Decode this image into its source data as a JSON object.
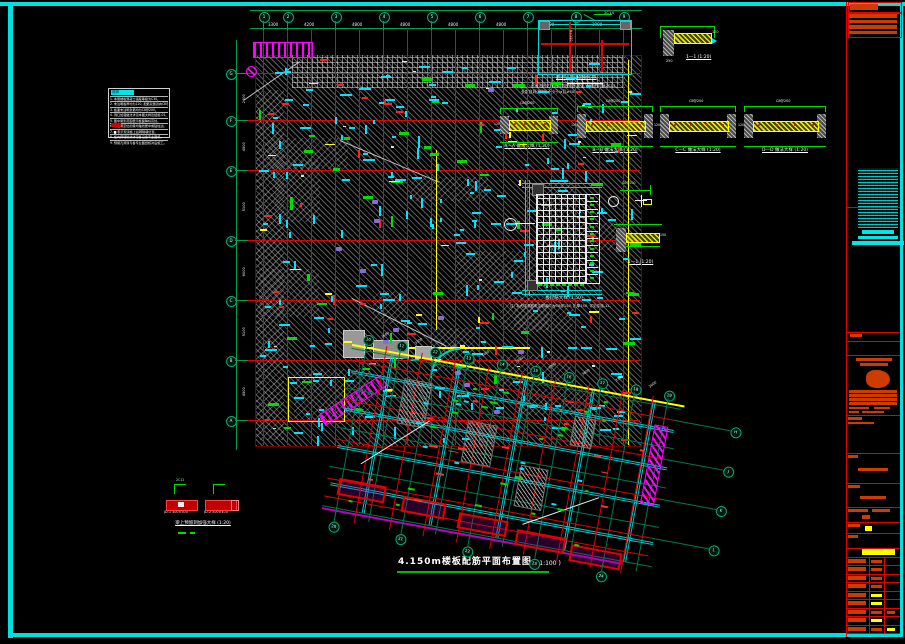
{
  "colors": {
    "frame_cyan": "#00e0e0",
    "grid_red": "#e60000",
    "dim_green": "#00a050",
    "anno_cyan": "#00e5ff",
    "rebar_green": "#00dd00",
    "yellow": "#ffff00",
    "magenta": "#ff00ff",
    "title_orange": "#cc3c00",
    "white": "#ffffff"
  },
  "notes_box": {
    "title": "说明",
    "rows": [
      "1. 本层楼板混凝土强度等级为C30。",
      "2. 未注明板厚均为120, 配筋双层双向C8@200。",
      "3. 板面未注明负筋均为C8@200。",
      "4. 洞口加强做法详见本图大样及结施-01。",
      "5. 图中阴影范围表示板面降标高处。",
      "6. 未注明定位的梁均轴线居中或贴柱边。",
      "7. ▆ 表示现浇板上后砌隔墙位置。",
      "8. 板内预埋管线详见各设备专业图纸。",
      "9. 预留孔洞须与各专业图纸核对后施工。"
    ]
  },
  "main_plan": {
    "title": "4.150m楼板配筋平面布置图",
    "scale": "( 1:100 )",
    "top_total": "34800",
    "top_bubbles": [
      "1",
      "2",
      "3",
      "4",
      "5",
      "6",
      "7",
      "8",
      "9"
    ],
    "top_dims": [
      "3300",
      "4200",
      "4800",
      "4800",
      "4800",
      "4800",
      "4200",
      "3900"
    ],
    "left_bubbles": [
      "G",
      "F",
      "E",
      "D",
      "C",
      "B",
      "A"
    ],
    "left_dims": [
      "2400",
      "4500",
      "5100",
      "6000",
      "5100",
      "4500"
    ]
  },
  "wing": {
    "top_bubbles": [
      "10",
      "11",
      "12",
      "13",
      "14",
      "15",
      "16",
      "17",
      "18",
      "19"
    ],
    "top_dims": [
      "3600",
      "3300",
      "3300",
      "3600",
      "3300",
      "3300",
      "3600",
      "3300",
      "3600"
    ],
    "bottom_bubbles": [
      "20",
      "21",
      "22",
      "23",
      "24"
    ],
    "right_bubbles": [
      "H",
      "J",
      "K",
      "L"
    ]
  },
  "details": {
    "opening": {
      "caption": "板洞口加强配筋示意",
      "note1": "注:1. 凡未注明之板洞口均按本图加强, 洞边附加筋2C14,",
      "note2": "      长度自洞边伸出不小于la且≥500。",
      "rebar_label": "2C14"
    },
    "s11a": {
      "caption": "1—1 (1:20)"
    },
    "sections": [
      {
        "caption": "A—A 做法大样 (1:20)"
      },
      {
        "caption": "B—B 做法大样 (1:20)"
      },
      {
        "caption": "C—C 做法大样 (1:20)"
      },
      {
        "caption": "D—D 做法大样 (1:20)"
      }
    ],
    "grid_plan": {
      "caption": "板配筋大样 (1:50)",
      "note": "注: 本大样钢筋未注明者均为C8@150, 板厚150, 详见结施-15。"
    },
    "s11b": {
      "caption": "1—1 (1:20)"
    },
    "hole": {
      "caption": "梁上预留洞加强大样 (1:20)",
      "item1": "JD-1 300×300",
      "item2": "JD-2 500×400"
    }
  }
}
